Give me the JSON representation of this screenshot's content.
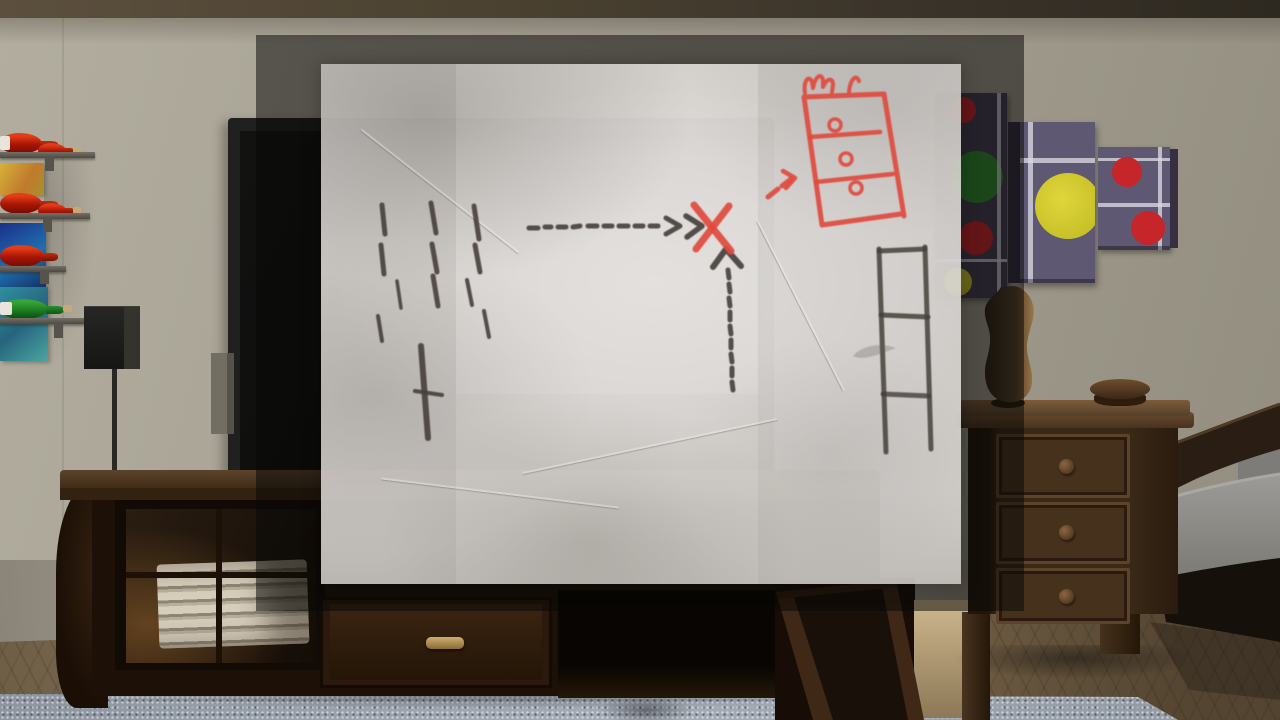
{
  "app": {
    "kind": "game-3d-room-with-inspected-note",
    "visible_text": []
  },
  "palette": {
    "wall": "#a39e90",
    "ceiling": "#4a4130",
    "floor": "#7d6a4e",
    "rug": "#99a1ab",
    "tv": "#202020",
    "screen": "#0b0b0a",
    "overlay": "rgba(8,7,5,0.52)",
    "paper": "rgba(233,230,225,0.90)",
    "marker": "#45403b",
    "red_ink": "#df4a3e",
    "panel_purple": "#5f5872",
    "panel_purple_dark": "#443d52",
    "circle_yellow": "#c0b822",
    "circle_green": "#2e8b2e",
    "circle_red": "#c6252a",
    "bottle_red": "#a81505",
    "bottle_green": "#1e7e22",
    "cork": "#c9a877",
    "brass": "#8a6c38",
    "mattress": "#8f8d89",
    "bronze": "#8a6b42"
  },
  "room": {
    "objects": [
      "wine-rack",
      "stained-glass-panels",
      "wall-speaker",
      "tv",
      "tv-stand",
      "towels",
      "open-glass-door",
      "wall-art-canvases",
      "mannequin-bust",
      "nightstand",
      "wooden-box",
      "bed",
      "rug"
    ]
  },
  "note": {
    "description": "hand-drawn treasure map on crumpled paper: dashes, arrows to red X, red dresser with crown, ladder",
    "dashes": [
      [
        382,
        205,
        385,
        234,
        5
      ],
      [
        381,
        245,
        384,
        274,
        5
      ],
      [
        378,
        316,
        382,
        341,
        4
      ],
      [
        397,
        281,
        401,
        308,
        3.5
      ],
      [
        431,
        203,
        436,
        233,
        5
      ],
      [
        432,
        244,
        437,
        272,
        5
      ],
      [
        433,
        276,
        438,
        306,
        5
      ],
      [
        474,
        206,
        479,
        239,
        5
      ],
      [
        475,
        245,
        480,
        272,
        5
      ],
      [
        467,
        280,
        472,
        305,
        4
      ],
      [
        484,
        311,
        489,
        337,
        4
      ],
      [
        421,
        346,
        428,
        438,
        6
      ],
      [
        415,
        391,
        442,
        395,
        4
      ],
      [
        529,
        228,
        538,
        228,
        5
      ],
      [
        545,
        227,
        551,
        227,
        5
      ],
      [
        558,
        227,
        566,
        227,
        5
      ],
      [
        573,
        227,
        580,
        226,
        5
      ],
      [
        588,
        226,
        597,
        226,
        5
      ],
      [
        604,
        226,
        612,
        226,
        5
      ],
      [
        619,
        226,
        628,
        226,
        5
      ],
      [
        635,
        226,
        643,
        226,
        5
      ],
      [
        650,
        226,
        658,
        226,
        5
      ],
      [
        728,
        270,
        729,
        278,
        5
      ],
      [
        729,
        284,
        730,
        292,
        5
      ],
      [
        729,
        298,
        730,
        306,
        5
      ],
      [
        730,
        312,
        730,
        320,
        5
      ],
      [
        730,
        326,
        731,
        334,
        5
      ],
      [
        731,
        340,
        731,
        348,
        5
      ],
      [
        731,
        354,
        732,
        362,
        5
      ],
      [
        732,
        368,
        732,
        376,
        5
      ],
      [
        732,
        382,
        733,
        390,
        5
      ]
    ],
    "paths": [
      {
        "name": "arrow-right-chevron-1",
        "d": "M666,218 L680,226 L666,234",
        "stroke": "marker",
        "w": 5
      },
      {
        "name": "arrow-right-chevron-2",
        "d": "M686,216 L702,226 L687,237",
        "stroke": "marker",
        "w": 5.5
      },
      {
        "name": "arrow-up-chevron",
        "d": "M713,267 L726,249 L741,266",
        "stroke": "marker",
        "w": 6
      },
      {
        "name": "x-mark-stroke-1",
        "d": "M694,205 L731,251",
        "stroke": "red",
        "w": 7
      },
      {
        "name": "x-mark-stroke-2",
        "d": "M729,206 L696,249",
        "stroke": "red",
        "w": 7
      },
      {
        "name": "red-arrow-seg-1",
        "d": "M768,197 L778,189",
        "stroke": "red",
        "w": 5
      },
      {
        "name": "red-arrow-seg-2",
        "d": "M782,186 L791,179",
        "stroke": "red",
        "w": 5
      },
      {
        "name": "red-arrow-head",
        "d": "M783,171 L795,178 L786,188",
        "stroke": "red",
        "w": 4.5
      },
      {
        "name": "dresser-outline",
        "d": "M804,97 L884,94 L904,216 M901,214 L822,225 L804,97",
        "stroke": "red",
        "w": 5
      },
      {
        "name": "dresser-divider-1",
        "d": "M810,137 L880,132",
        "stroke": "red",
        "w": 4.5
      },
      {
        "name": "dresser-divider-2",
        "d": "M816,182 L893,174",
        "stroke": "red",
        "w": 4.5
      },
      {
        "name": "dresser-crown",
        "d": "M805,93 C803,81 809,74 812,82 L813,88 C815,77 821,72 823,80 L823,87 C827,78 833,77 833,85 L832,92",
        "stroke": "red",
        "w": 4
      },
      {
        "name": "dresser-crown-right",
        "d": "M849,92 C850,80 856,73 859,81",
        "stroke": "red",
        "w": 4
      },
      {
        "name": "ladder-rail-left",
        "d": "M879,249 L886,452",
        "stroke": "marker",
        "w": 5,
        "op": 0.85
      },
      {
        "name": "ladder-rail-right",
        "d": "M925,247 L931,449",
        "stroke": "marker",
        "w": 5,
        "op": 0.85
      },
      {
        "name": "ladder-rung-top",
        "d": "M879,251 L925,249",
        "stroke": "marker",
        "w": 5,
        "op": 0.85
      },
      {
        "name": "ladder-rung-mid",
        "d": "M881,315 L928,317",
        "stroke": "marker",
        "w": 5,
        "op": 0.85
      },
      {
        "name": "ladder-rung-low",
        "d": "M883,394 L929,396",
        "stroke": "marker",
        "w": 5,
        "op": 0.8
      },
      {
        "name": "pencil-smudge",
        "d": "M853,356 C862,346 880,342 896,348 C884,352 864,362 853,356 Z",
        "stroke": "none",
        "w": 0,
        "fill": "rgba(95,88,82,0.30)"
      }
    ],
    "circles": [
      {
        "name": "dresser-knob-1",
        "cx": 835,
        "cy": 125,
        "r": 6,
        "stroke": "red",
        "w": 3.5
      },
      {
        "name": "dresser-knob-2",
        "cx": 846,
        "cy": 159,
        "r": 6,
        "stroke": "red",
        "w": 3.5
      },
      {
        "name": "dresser-knob-3",
        "cx": 856,
        "cy": 188,
        "r": 6,
        "stroke": "red",
        "w": 3.5
      }
    ]
  }
}
